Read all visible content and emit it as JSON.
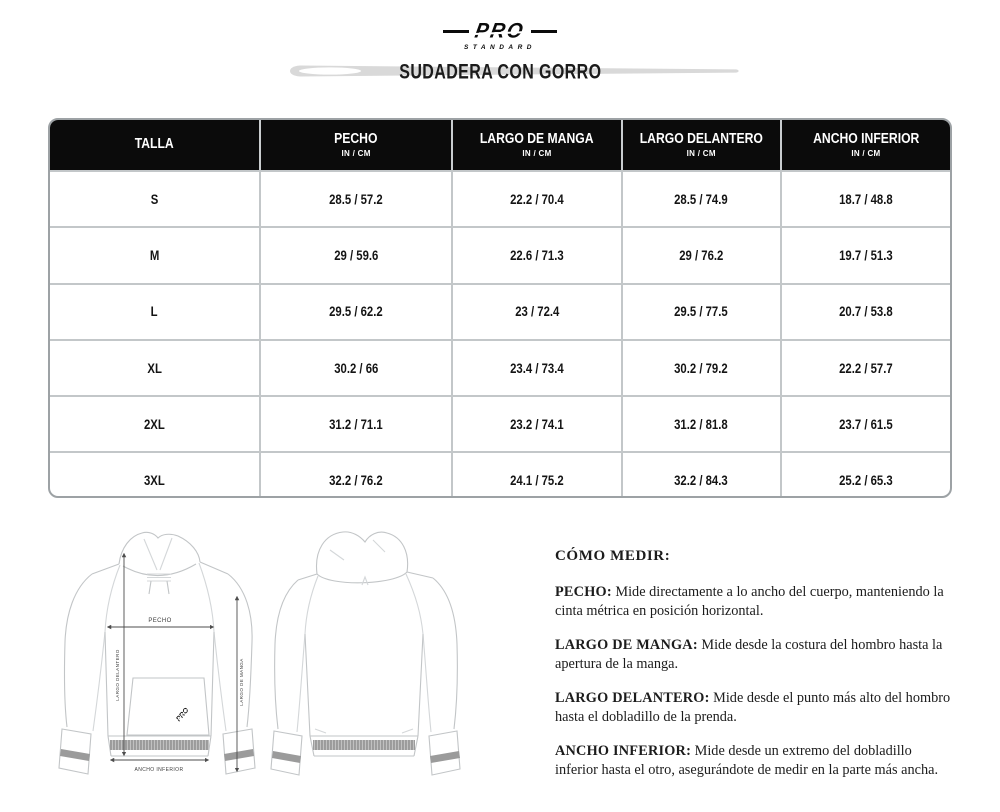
{
  "brand": {
    "wordmark": "PRO",
    "tagline": "STANDARD"
  },
  "title": "SUDADERA CON GORRO",
  "table": {
    "columns": [
      {
        "label": "TALLA",
        "sub": ""
      },
      {
        "label": "PECHO",
        "sub": "IN / CM"
      },
      {
        "label": "LARGO DE MANGA",
        "sub": "IN / CM"
      },
      {
        "label": "LARGO DELANTERO",
        "sub": "IN / CM"
      },
      {
        "label": "ANCHO INFERIOR",
        "sub": "IN / CM"
      }
    ],
    "rows": [
      {
        "size": "S",
        "values": [
          "28.5 / 57.2",
          "22.2 / 70.4",
          "28.5 / 74.9",
          "18.7 / 48.8"
        ]
      },
      {
        "size": "M",
        "values": [
          "29 / 59.6",
          "22.6 / 71.3",
          "29 / 76.2",
          "19.7 / 51.3"
        ]
      },
      {
        "size": "L",
        "values": [
          "29.5 / 62.2",
          "23 / 72.4",
          "29.5 / 77.5",
          "20.7 / 53.8"
        ]
      },
      {
        "size": "XL",
        "values": [
          "30.2 / 66",
          "23.4 / 73.4",
          "30.2 / 79.2",
          "22.2 / 57.7"
        ]
      },
      {
        "size": "2XL",
        "values": [
          "31.2 / 71.1",
          "23.2 / 74.1",
          "31.2 / 81.8",
          "23.7 / 61.5"
        ]
      },
      {
        "size": "3XL",
        "values": [
          "32.2 / 76.2",
          "24.1 / 75.2",
          "32.2 / 84.3",
          "25.2 / 65.3"
        ]
      }
    ]
  },
  "diagram": {
    "pecho_label": "PECHO",
    "largo_delantero_label": "LARGO DELANTERO",
    "largo_de_manga_label": "LARGO DE MANGA",
    "ancho_inferior_label": "ANCHO INFERIOR",
    "pocket_logo": "PRO"
  },
  "how_to_measure": {
    "heading": "CÓMO MEDIR:",
    "items": [
      {
        "term": "PECHO:",
        "text": "Mide directamente a lo ancho del cuerpo, manteniendo la cinta métrica en posición horizontal."
      },
      {
        "term": "LARGO DE MANGA:",
        "text": "Mide desde la costura del hombro hasta la apertura de la manga."
      },
      {
        "term": "LARGO DELANTERO:",
        "text": "Mide desde el punto más alto del hombro hasta el dobladillo de la prenda."
      },
      {
        "term": "ANCHO INFERIOR:",
        "text": "Mide desde un extremo del dobladillo inferior hasta el otro, asegurándote de medir en la parte más ancha."
      }
    ]
  },
  "colors": {
    "header_bg": "#0b0b0b",
    "header_text": "#ffffff",
    "table_border": "#9da2a5",
    "needle_gray": "#d9d9d9",
    "outline_gray": "#c5c8ca",
    "arrow_gray": "#4d4d4d"
  }
}
